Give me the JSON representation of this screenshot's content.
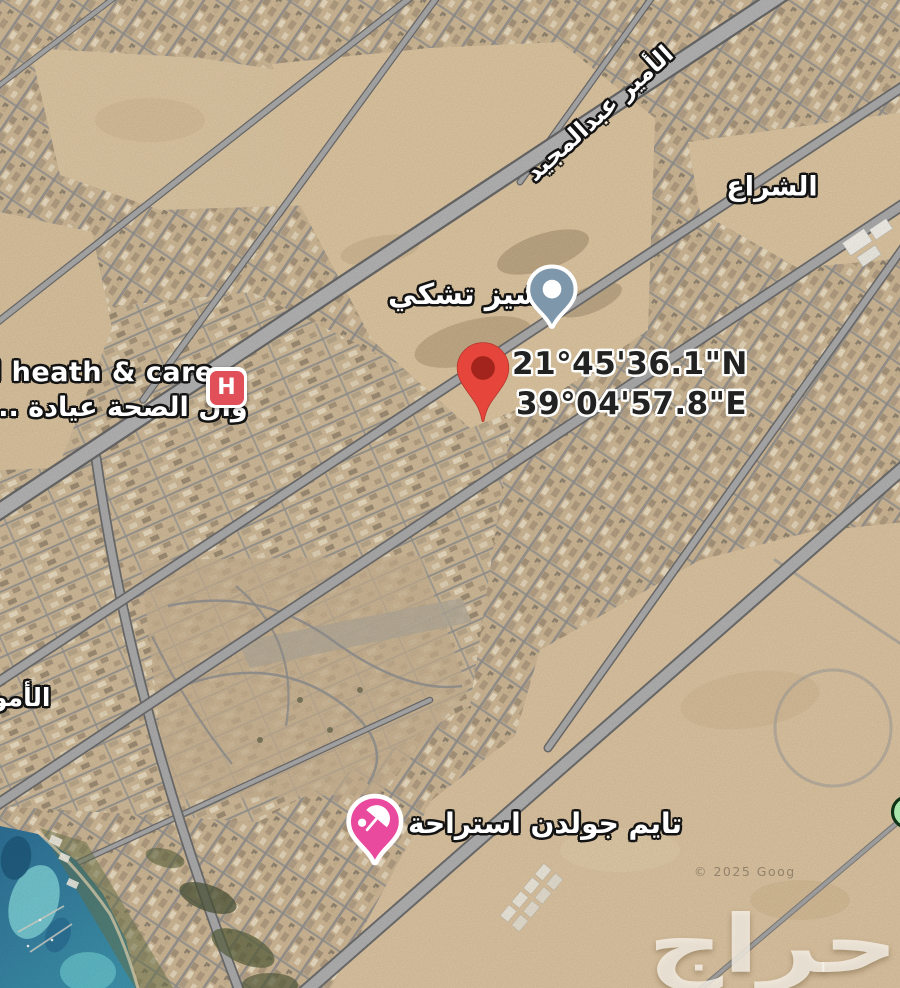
{
  "map": {
    "labels": {
      "road": "الأمير عبدالمجيد",
      "district": "الشراع",
      "district_partial": "الأمو"
    },
    "location_pin": {
      "lat": "21°45'36.1\"N",
      "lon": "39°04'57.8\"E",
      "pin_color": "#E5453B",
      "pin_inner_color": "#992018"
    },
    "pois": {
      "cheesecake": {
        "label": "تشيز تشكي",
        "marker_color": "#7E97AA"
      },
      "clinic": {
        "name_en": "l heath & care",
        "name_ar": "وال الصحة عيادة ...",
        "icon_letter": "H",
        "icon_color": "#E14F58"
      },
      "resort": {
        "label": "تايم جولدن استراحة",
        "marker_color": "#E94A9E"
      },
      "green_marker_color": "#A9E6AC"
    },
    "watermark": "حراج",
    "copyright": "© 2025 Goog"
  }
}
